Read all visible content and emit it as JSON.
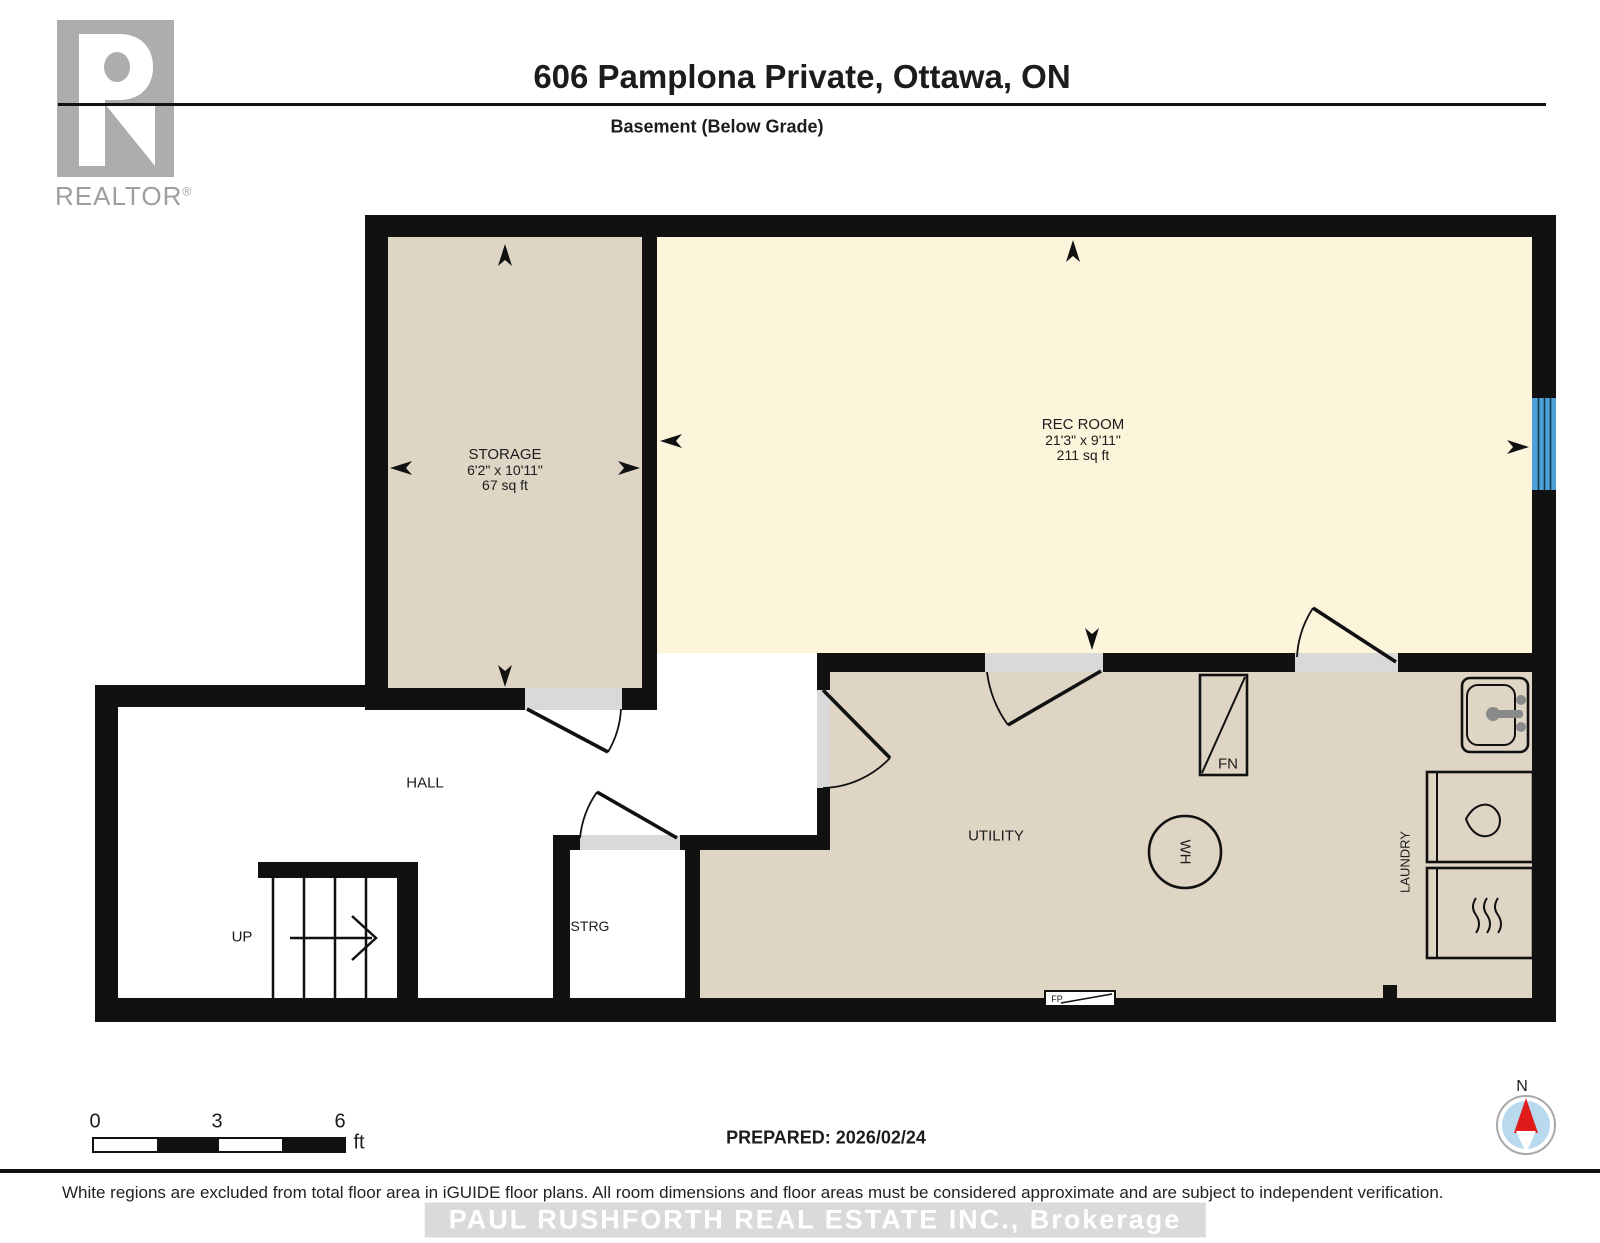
{
  "branding": {
    "realtor_logo_letter": "R",
    "realtor_logo_text": "REALTOR",
    "registered_mark": "®"
  },
  "header": {
    "title": "606 Pamplona Private, Ottawa, ON",
    "subtitle": "Basement (Below Grade)"
  },
  "rooms": {
    "storage": {
      "name": "STORAGE",
      "dimensions": "6'2\" x 10'11\"",
      "area": "67 sq ft"
    },
    "rec_room": {
      "name": "REC ROOM",
      "dimensions": "21'3\" x 9'11\"",
      "area": "211 sq ft"
    },
    "hall": {
      "name": "HALL"
    },
    "stairs": {
      "name": "UP"
    },
    "strg": {
      "name": "STRG"
    },
    "utility": {
      "name": "UTILITY"
    },
    "laundry": {
      "name": "LAUNDRY"
    }
  },
  "fixtures": {
    "furnace": "FN",
    "water_heater": "WH",
    "fireplace": "FP"
  },
  "scale_bar": {
    "start": "0",
    "mid": "3",
    "end": "6",
    "unit": "ft"
  },
  "compass": {
    "label": "N"
  },
  "prepared_label": "PREPARED: 2026/02/24",
  "footer": {
    "disclaimer": "White regions are excluded from total floor area in iGUIDE floor plans. All room dimensions and floor areas must be considered approximate and are subject to independent verification.",
    "watermark": "PAUL RUSHFORTH REAL ESTATE INC., Brokerage"
  },
  "colors": {
    "wall": "#111111",
    "room_fill_included": "#ded5c5",
    "room_fill_rec": "#fcf5dc",
    "door_opening": "#d9d9d9",
    "window_blue": "#4ba1d8",
    "compass_blue": "#b9d9ef",
    "compass_needle_red": "#e01b1b",
    "logo_gray": "#adadad",
    "watermark_band_gray": "#dadada"
  }
}
